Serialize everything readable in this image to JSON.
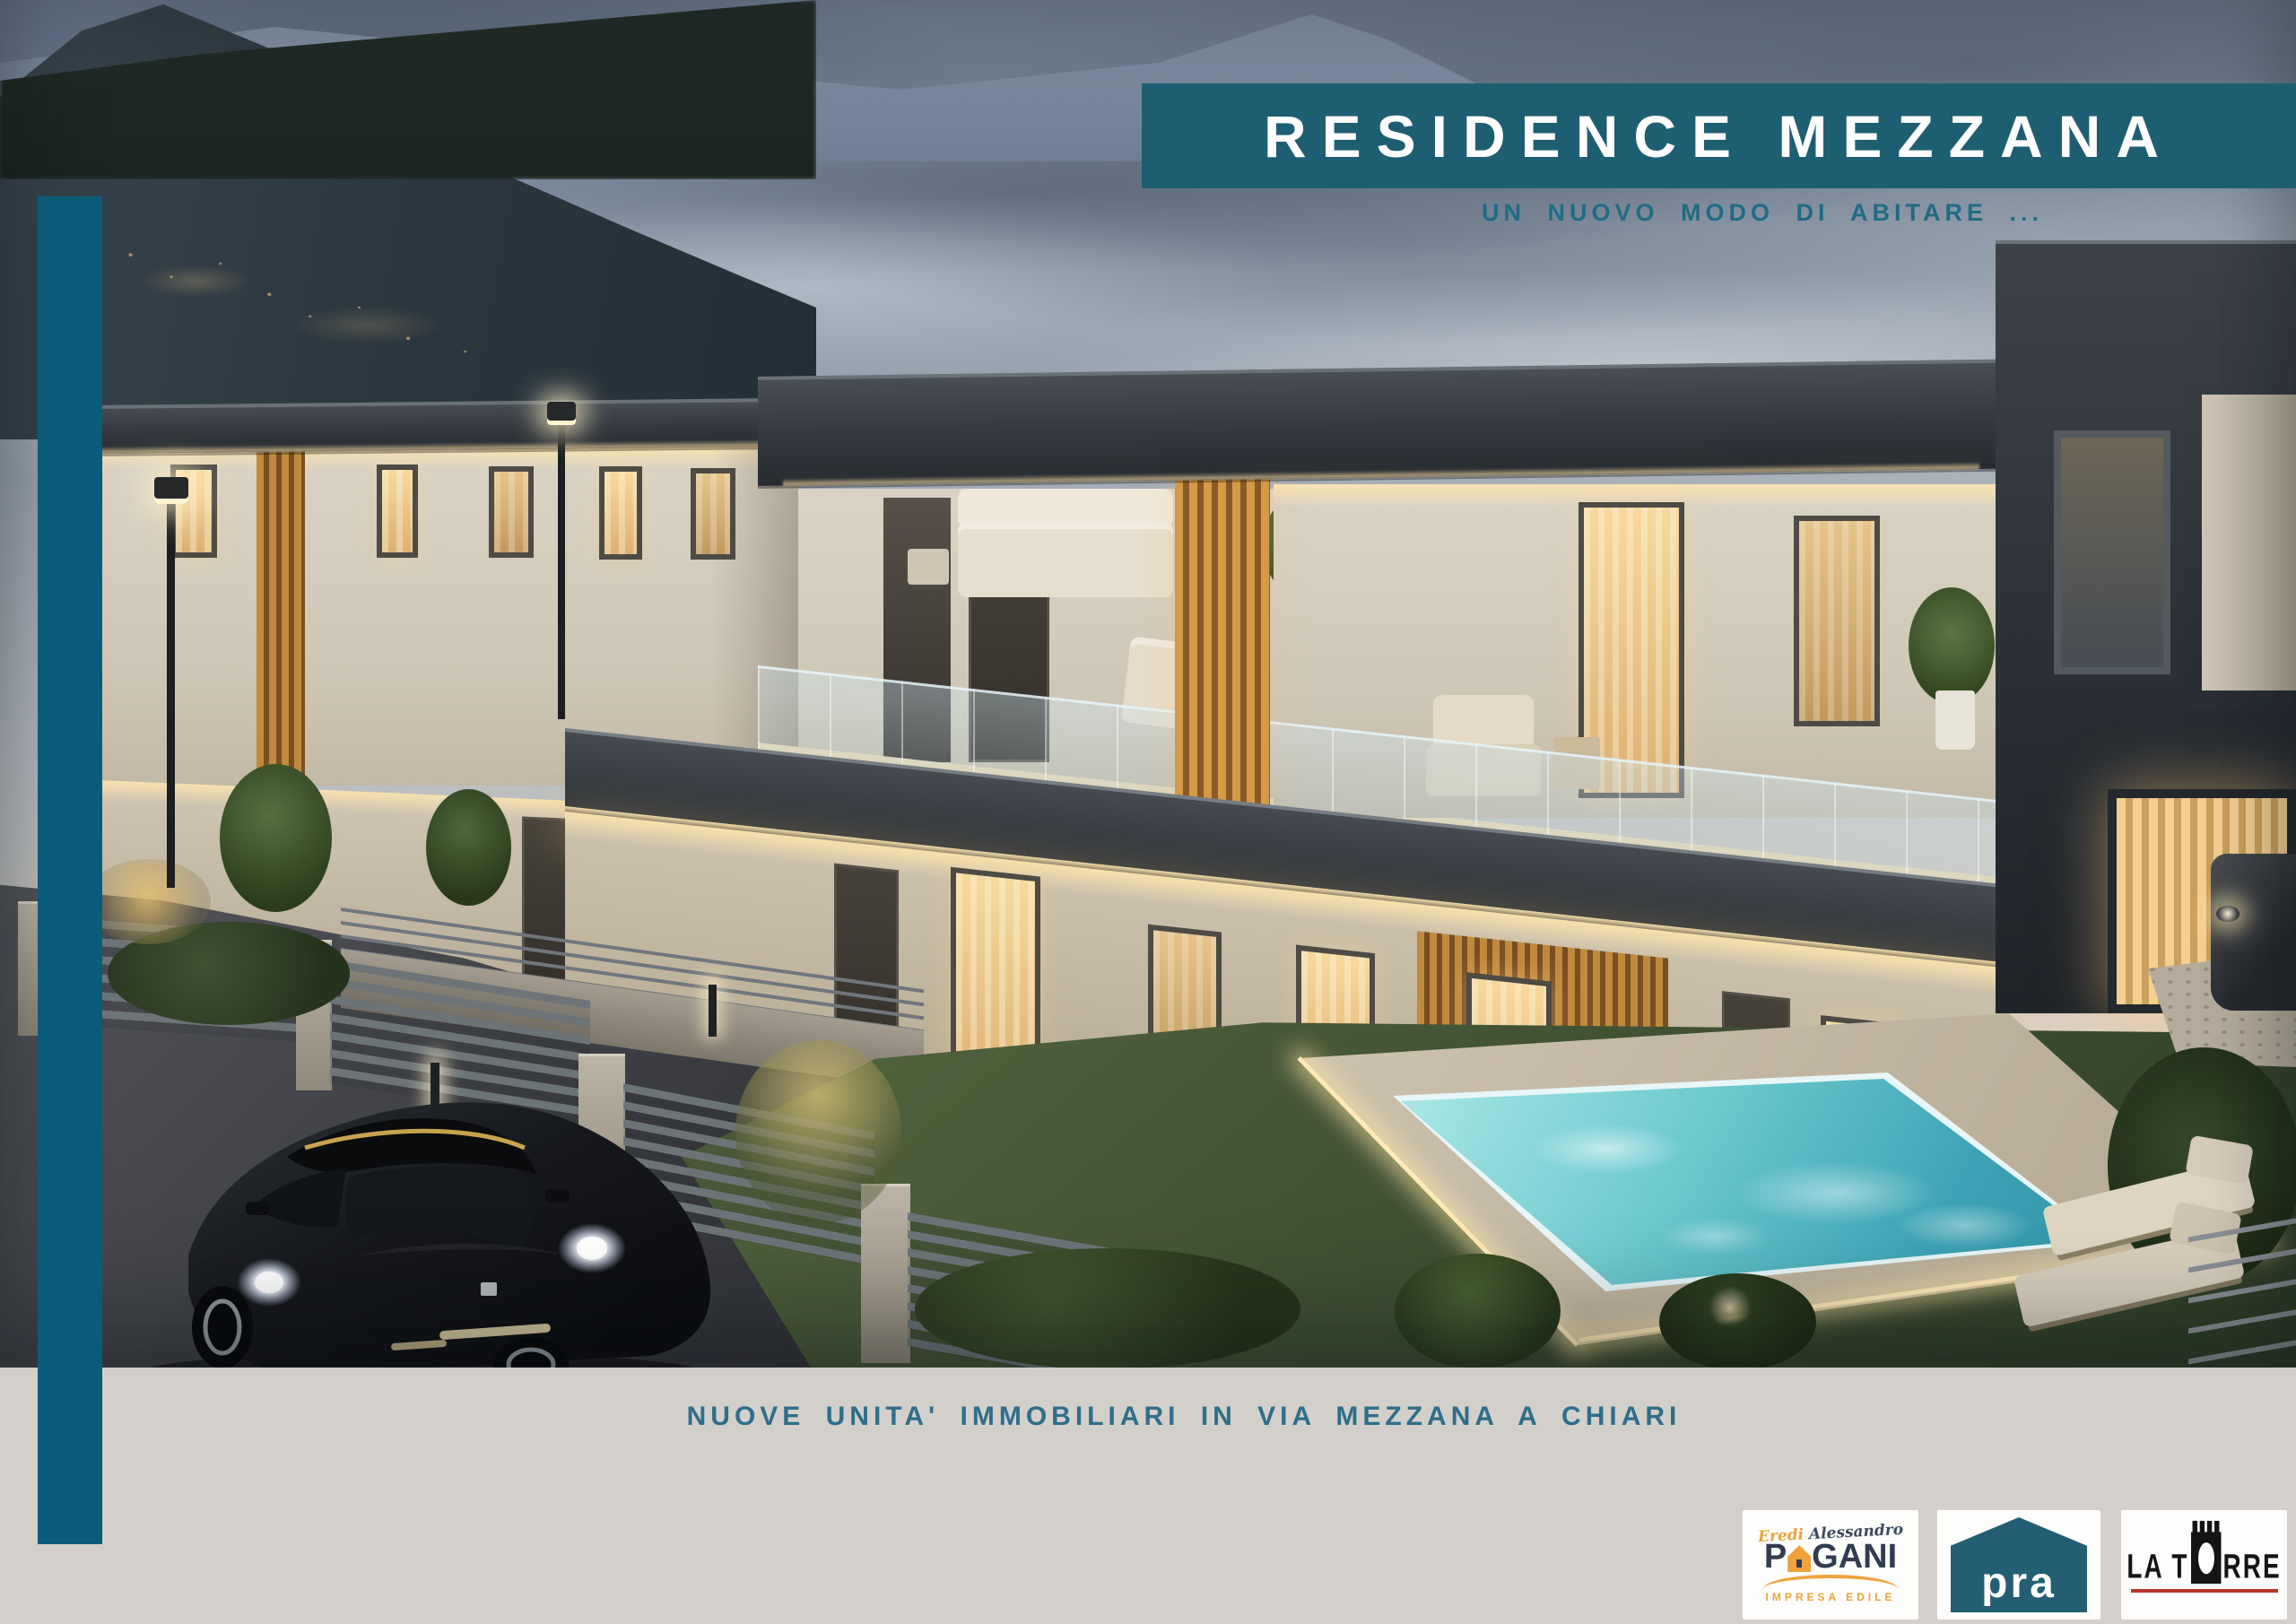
{
  "banner": {
    "title": "RESIDENCE MEZZANA",
    "subtitle": "UN NUOVO MODO DI ABITARE ...",
    "background_color": "#1e5e72",
    "title_color": "#ffffff",
    "subtitle_color": "#1f6b85"
  },
  "accent_bar": {
    "color": "#0b5c7b"
  },
  "footer": {
    "caption": "NUOVE UNITA' IMMOBILIARI IN VIA MEZZANA A CHIARI",
    "caption_color": "#2e6e8a",
    "background_color": "#d3d0cb"
  },
  "logos": {
    "pagani": {
      "script_first": "Eredi",
      "script_second": "Alessandro",
      "name_prefix": "P",
      "name_suffix": "GANI",
      "full_name": "PAGANI",
      "tagline": "IMPRESA EDILE",
      "navy_color": "#303c50",
      "orange_color": "#f0a23c"
    },
    "pra": {
      "name": "pra",
      "house_color": "#235e74",
      "text_color": "#ffffff"
    },
    "la_torre": {
      "name_left": "LA T",
      "name_right": "RRE",
      "full_name": "LA TORRE",
      "text_color": "#141414",
      "underline_color": "#b8372c"
    }
  },
  "scene": {
    "sky_top_color": "#6f7e95",
    "sky_horizon_color": "#e3d3c0",
    "hill_color": "#2c3840",
    "roof_color": "#3a4147",
    "facade_color": "#d8d1c2",
    "wood_slat_color": "#c08a3e",
    "window_glow_color": "#f0cf96",
    "pool_water_color": "#54b9c6",
    "grass_color": "#44553a",
    "asphalt_color": "#3a3c41",
    "car_color": "#101114"
  }
}
